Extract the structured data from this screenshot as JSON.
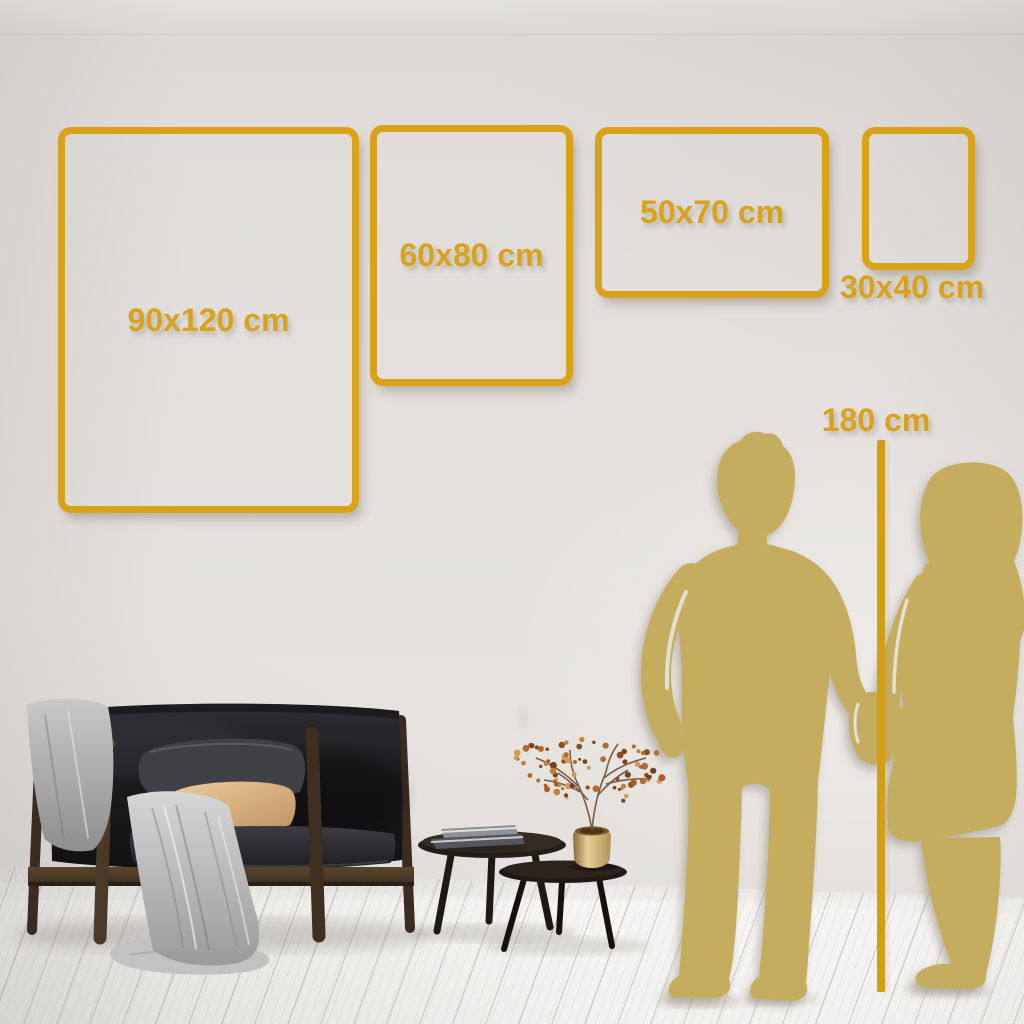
{
  "size_frames": [
    {
      "id": "90x120",
      "label": "90x120 cm",
      "orientation": "portrait",
      "label_placement": "inside"
    },
    {
      "id": "60x80",
      "label": "60x80 cm",
      "orientation": "portrait",
      "label_placement": "inside"
    },
    {
      "id": "50x70",
      "label": "50x70 cm",
      "orientation": "landscape",
      "label_placement": "inside"
    },
    {
      "id": "30x40",
      "label": "30x40 cm",
      "orientation": "portrait",
      "label_placement": "below"
    }
  ],
  "height_marker": {
    "label": "180 cm"
  },
  "colors": {
    "accent_gold": "#d9a21b",
    "height_line_gold": "#d29e15",
    "silhouette_gold": "#c5ad5f",
    "wall": "#e2dfdb",
    "floor": "#f3f2f0",
    "sofa_black": "#1b1b1e",
    "pillow_gray": "#3f4146",
    "pillow_tan": "#dcb987",
    "blanket_gray": "#b5b5b5",
    "wood_brown": "#4a3829",
    "table_black": "#27211b",
    "vase_brass": "#c9ae7c",
    "plant_berry": "#b06a30"
  }
}
